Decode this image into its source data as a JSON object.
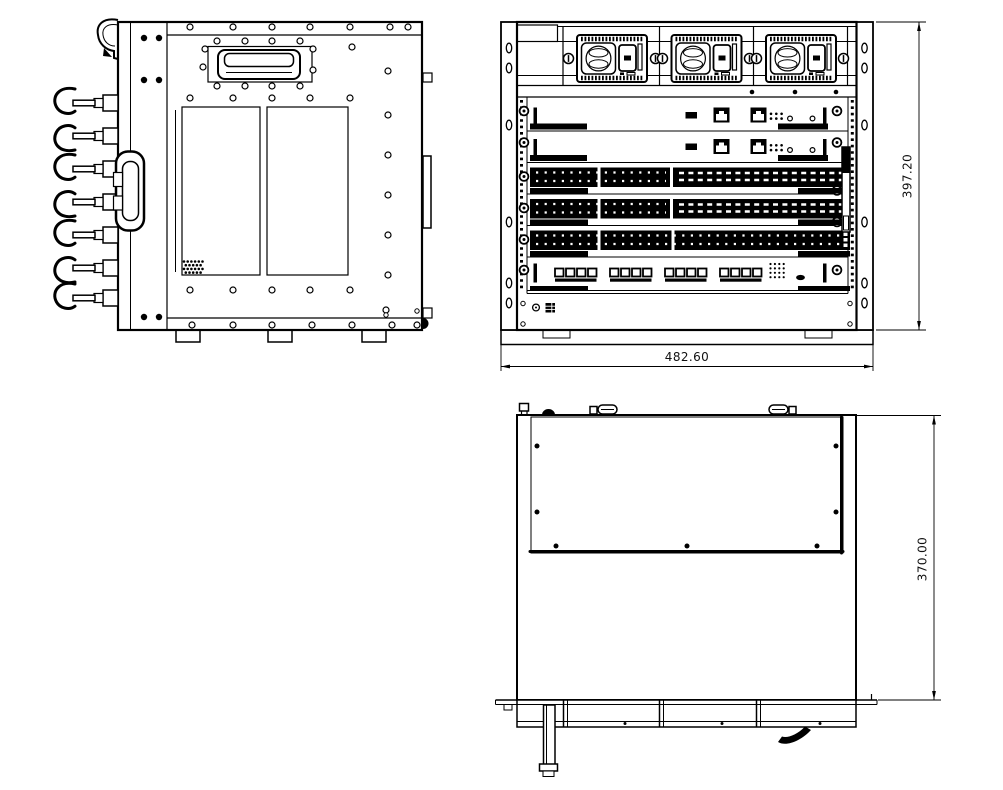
{
  "drawing": {
    "dimensions": {
      "front_height": "397.20",
      "front_width": "482.60",
      "top_depth": "370.00"
    },
    "colors": {
      "line": "#000000",
      "background": "#ffffff"
    }
  }
}
